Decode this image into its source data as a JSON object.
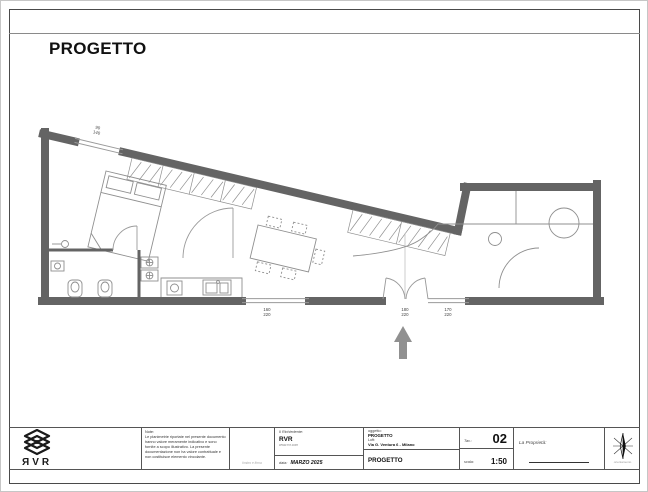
{
  "page": {
    "title": "PROGETTO"
  },
  "plan": {
    "dims": [
      {
        "w": "90",
        "h": "140"
      },
      {
        "w": "160",
        "h": "220"
      },
      {
        "w": "180",
        "h": "220"
      },
      {
        "w": "170",
        "h": "220"
      }
    ],
    "scale_note": "1:50"
  },
  "titleblock": {
    "logo_text": "ЯVR",
    "note_label": "Note:",
    "note_text": "Le planimetrie riportate nel presente documento hanno valore meramente indicativo e sono fornite a scopo illustrativo. La presente documentazione non ha valore contrattuale e non costituisce elemento vincolante.",
    "stamp_hint": "timbro e firma",
    "richiedente_label": "Il Richiedente:",
    "richiedente_name": "RVR",
    "richiedente_web": "www.rvr.com",
    "date_label": "data:",
    "date_value": "MARZO 2025",
    "oggetto_label": "oggetto:",
    "oggetto_project": "PROGETTO",
    "oggetto_loft": "Loft:",
    "oggetto_address": "Via G. Ventura 6 - Milano",
    "drawing_title": "PROGETTO",
    "tav_label": "Tav.:",
    "tav_value": "02",
    "scala_label": "scala:",
    "scala_value": "1:50",
    "proprieta_label": "La Proprietà:",
    "compass_caption": "orientamento"
  }
}
